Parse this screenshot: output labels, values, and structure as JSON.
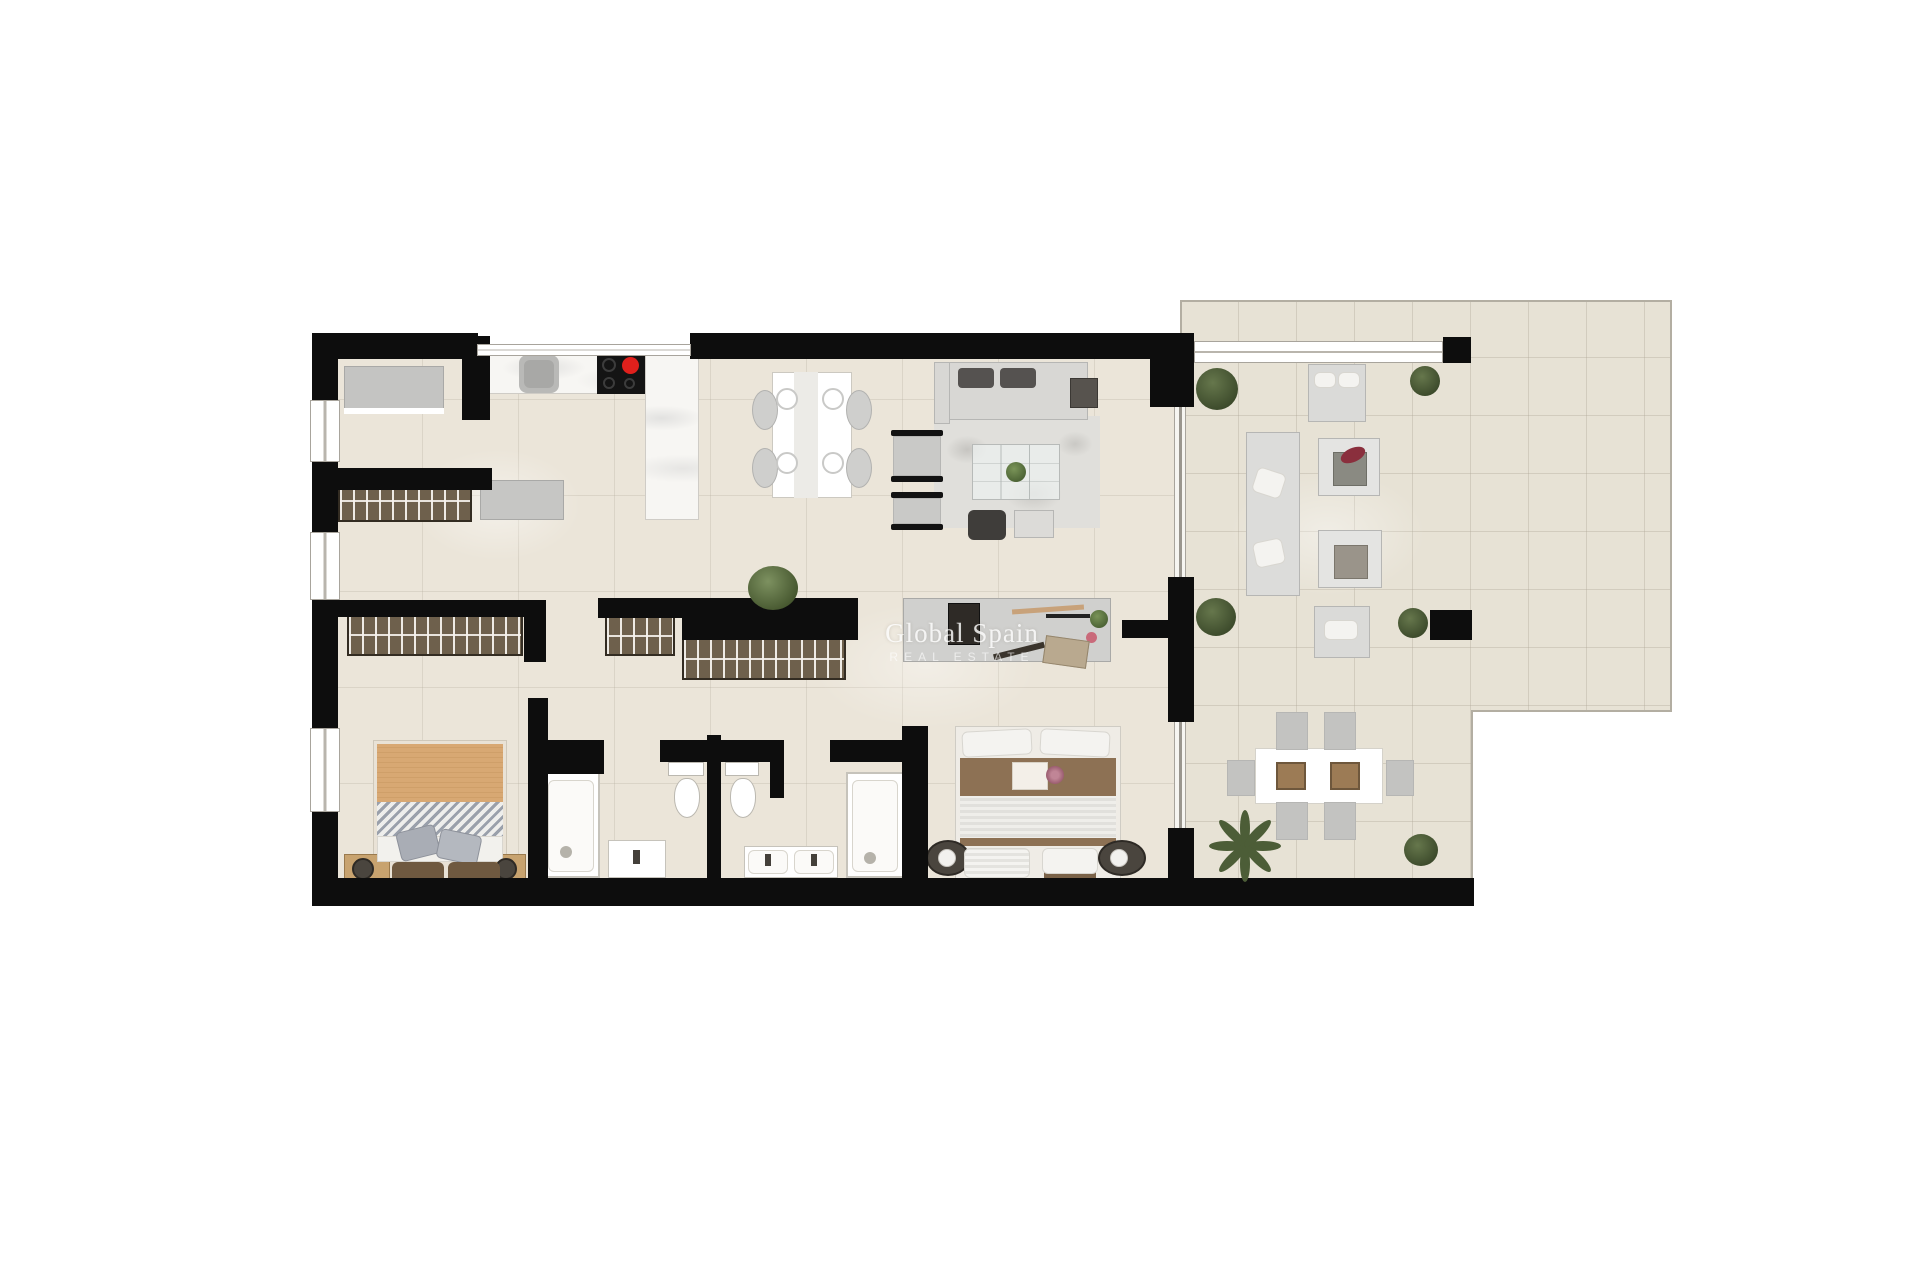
{
  "watermark": {
    "title": "Global Spain",
    "subtitle": "REAL ESTATE"
  },
  "colors": {
    "background": "#ffffff",
    "wall": "#0d0d0d",
    "apartment_floor": "#ebe5d9",
    "terrace_floor": "#e7e2d5",
    "kitchen_counter_marble": "#f7f6f3",
    "wardrobe_wood": "#6e604c",
    "cabinet_gray": "#c6c6c4",
    "sofa_gray": "#d8d7d4",
    "bed_blanket_tan": "#d8a873",
    "bed_blanket_brown": "#8d7154",
    "plant_green": "#4e5f38",
    "hob_burner_on_red": "#e0201c"
  }
}
